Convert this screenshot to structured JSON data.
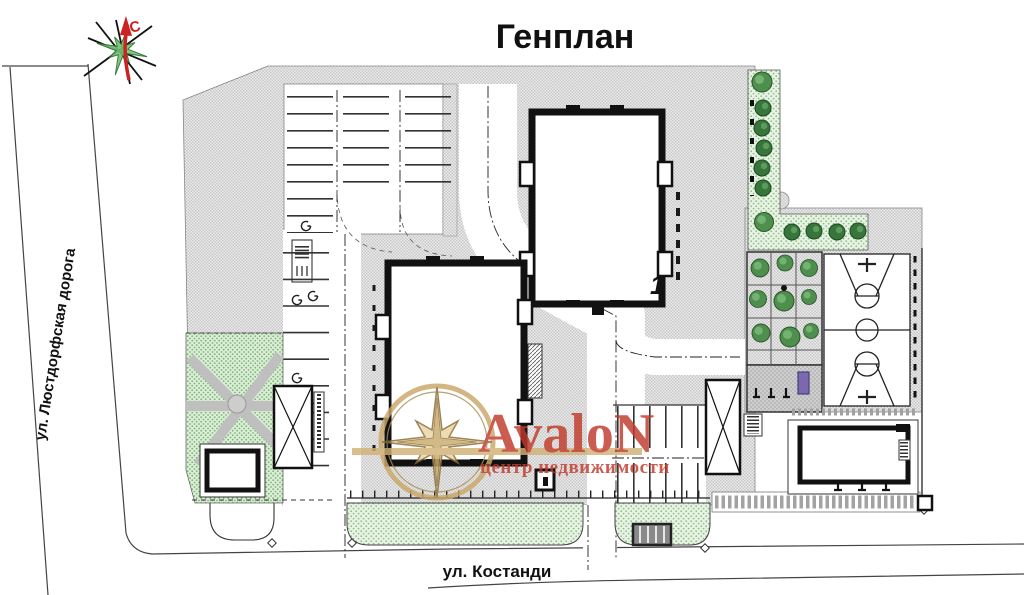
{
  "title": "Генплан",
  "compass": {
    "north_label": "С"
  },
  "streets": {
    "left_label": "ул. Люстдорфская дорога",
    "bottom_label": "ул. Костанди"
  },
  "site": {
    "building1_label": "1",
    "features": [
      "building-1",
      "building-2",
      "service-building",
      "parking-top",
      "parking-side",
      "parking-bottom",
      "playground",
      "basketball-court",
      "green-zone-left",
      "green-strip-topright",
      "lawn-strips-bottom",
      "sidewalk",
      "existing-structure-x"
    ]
  },
  "watermark": {
    "brand": "AvaloN",
    "tagline": "центр недвижимости"
  },
  "colors": {
    "brand_red": "#c0392b",
    "gold": "#d2b176",
    "lawn_green": "#9cc79a",
    "hedge_green": "#2f6b2f",
    "paving_grey": "#c9c9c9",
    "wall_black": "#111111",
    "north_arrow_red": "#cc2222",
    "compass_green": "#74c274",
    "playground_purple": "#7b68ae"
  }
}
